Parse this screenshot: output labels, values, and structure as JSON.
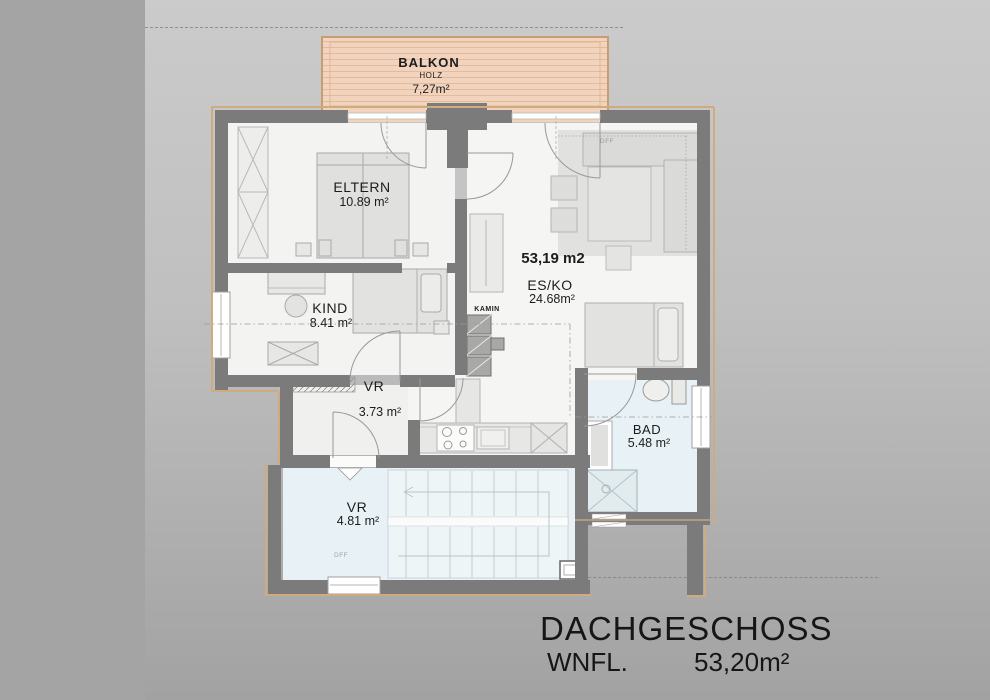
{
  "plan": {
    "balkon": {
      "name": "BALKON",
      "material": "HOLZ",
      "area": "7,27m²"
    },
    "eltern": {
      "name": "ELTERN",
      "area": "10.89 m²"
    },
    "kind": {
      "name": "KIND",
      "area": "8.41 m²"
    },
    "vr_upper": {
      "name": "VR",
      "area": "3.73 m²"
    },
    "esko": {
      "name": "ES/KO",
      "area": "24.68m²",
      "total": "53,19 m2"
    },
    "kamin": {
      "name": "KAMIN"
    },
    "bad": {
      "name": "BAD",
      "area": "5.48 m²"
    },
    "vr_lower": {
      "name": "VR",
      "area": "4.81 m²"
    },
    "dff_esko": "DFF",
    "dff_vr": "DFF"
  },
  "title_block": {
    "floor_name": "DACHGESCHOSS",
    "area_label": "WNFL.",
    "area_value": "53,20m²"
  },
  "colors": {
    "background": "#a4a4a4",
    "sheet": "#c9c9c9",
    "wall": "#7b7b7b",
    "room_floor": "#f4f4f3",
    "wet_floor": "#e8f1f5",
    "balcony_wood": "#f2d4be",
    "roof_edge_line": "#cfab7f",
    "text": "#1d1d1d"
  }
}
